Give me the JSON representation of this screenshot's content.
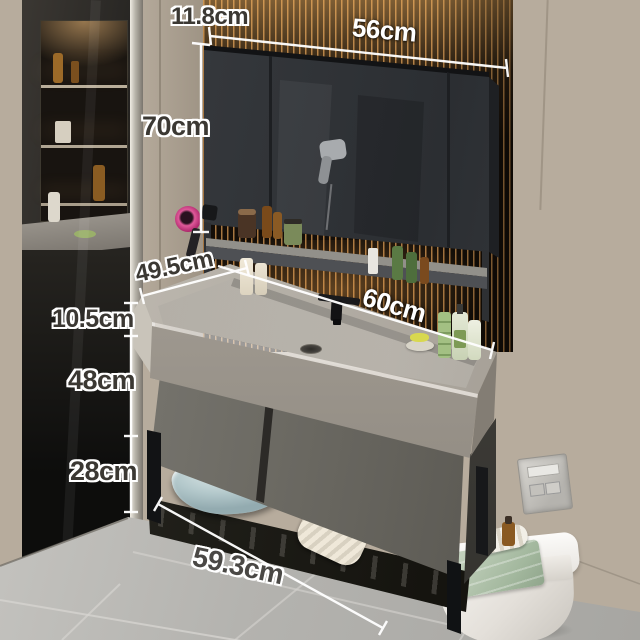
{
  "dims": {
    "mirror_depth": "11.8cm",
    "mirror_width": "56cm",
    "mirror_height": "70cm",
    "counter_depth": "49.5cm",
    "counter_width": "60cm",
    "counter_height": "10.5cm",
    "cabinet_height": "48cm",
    "clearance_height": "28cm",
    "base_width": "59.3cm"
  },
  "colors": {
    "wall_beige": "#bfb5a6",
    "slat_wood_dark": "#140e08",
    "slat_glow_amber": "#c98b4a",
    "mirror_cabinet_gray": "#33363a",
    "counter_gray": "#b3aea5",
    "drawer_gray": "#6b6962",
    "metal_frame_black": "#121315",
    "floor_gray": "#b2b1ad",
    "basin_blue": "#bcd3d5",
    "towel_green": "#aebfa8",
    "toilet_white": "#f2f0ec",
    "dim_line_white": "#ffffff",
    "dim_text_dark": "#3b3833"
  }
}
